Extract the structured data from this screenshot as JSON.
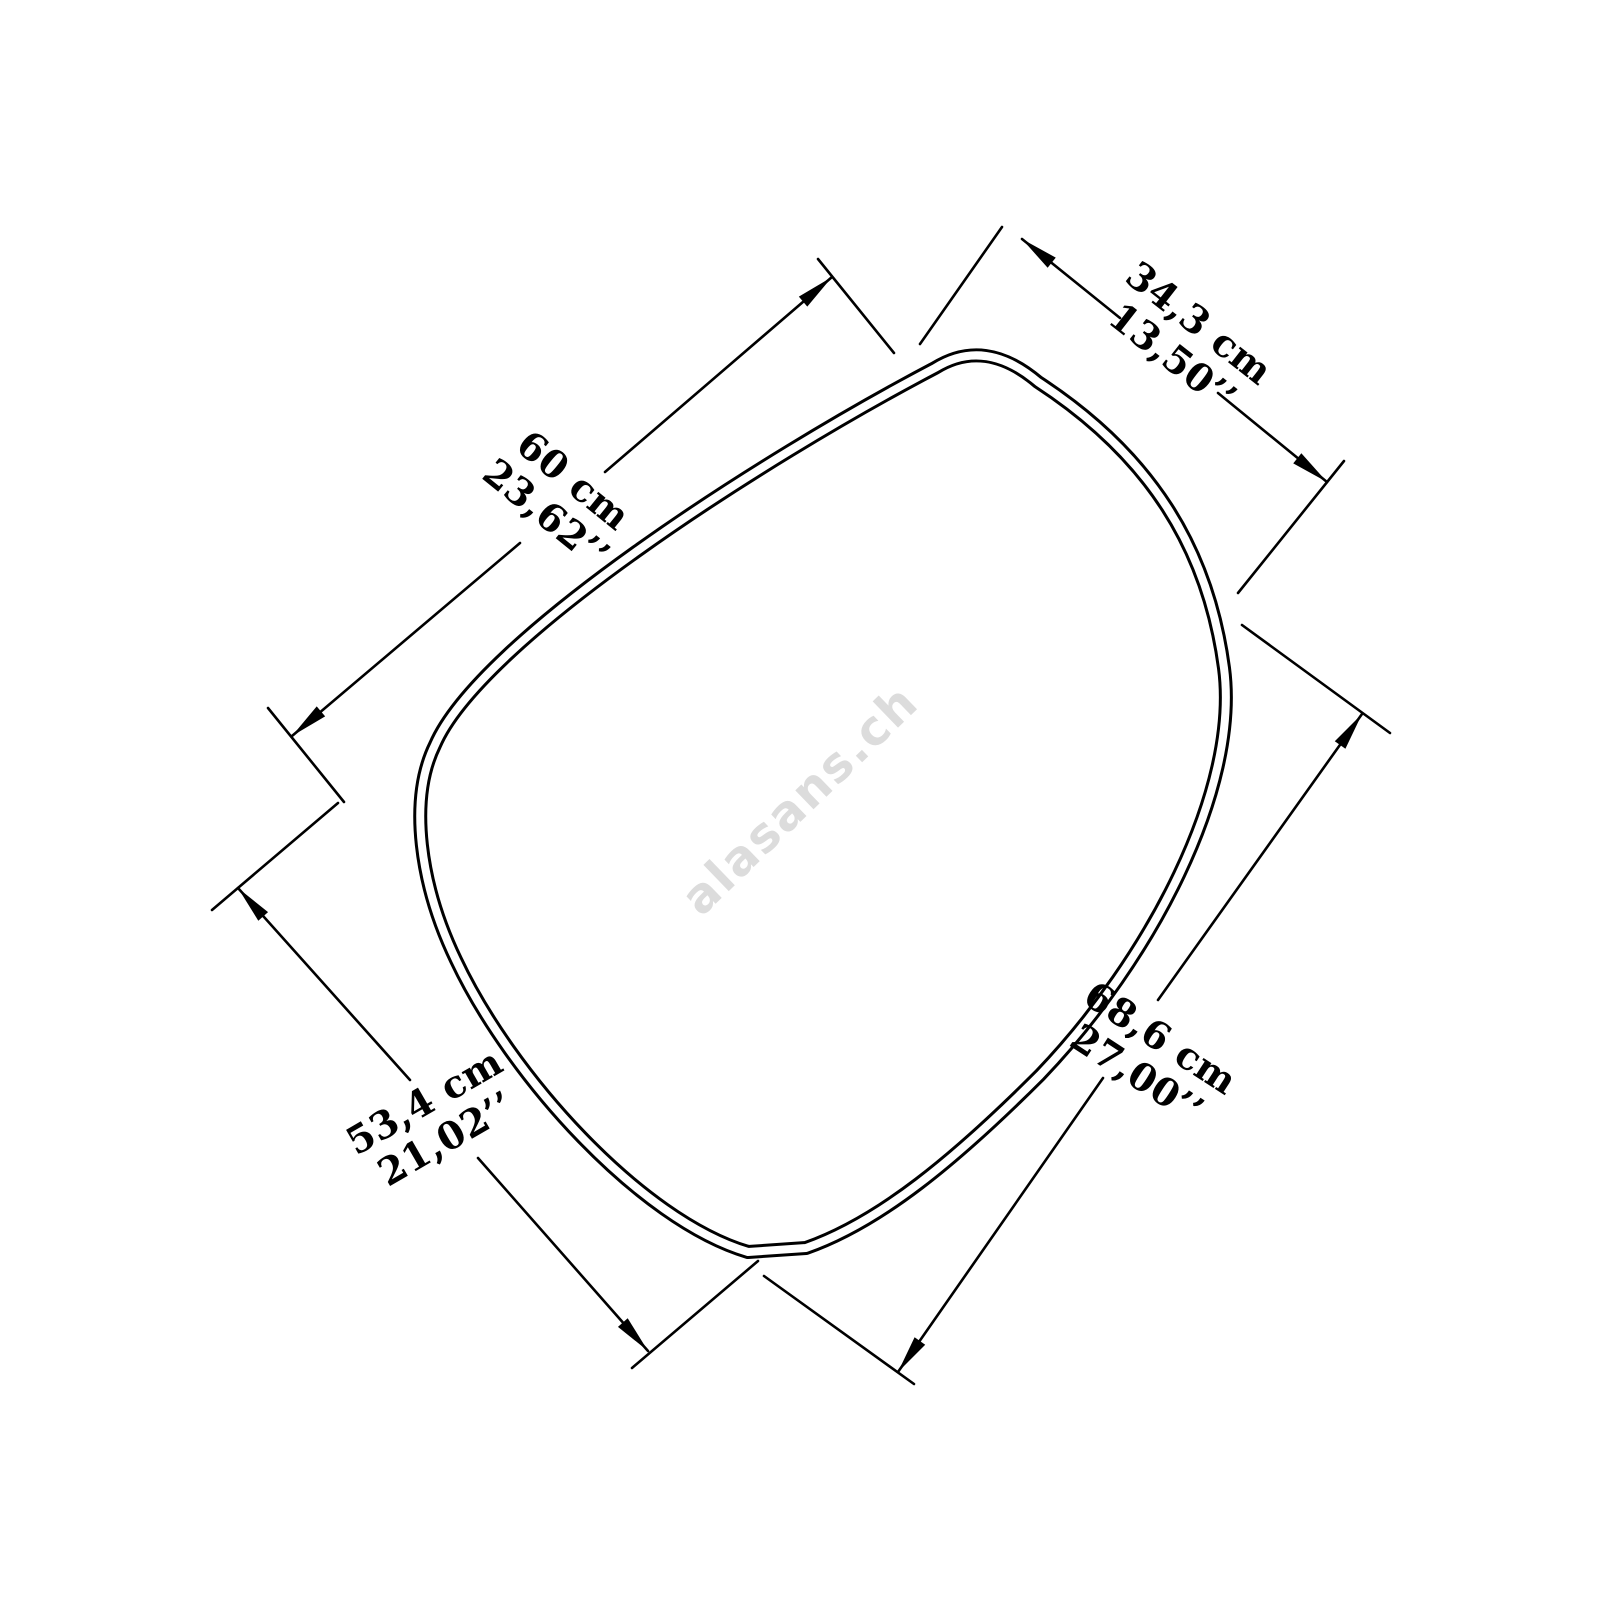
{
  "page": {
    "background": "#ffffff",
    "line_color": "#000000"
  },
  "watermark": {
    "text": "alasans.ch",
    "color": "#dcdcdc"
  },
  "diagram": {
    "shape": "organic-pebble-mirror-outline",
    "dimensions": [
      {
        "edge": "upper-left-edge",
        "cm": "60 cm",
        "inches": "23,62’’"
      },
      {
        "edge": "top-right-edge",
        "cm": "34,3 cm",
        "inches": "13,50’’"
      },
      {
        "edge": "lower-right-edge",
        "cm": "68,6 cm",
        "inches": "27,00’’"
      },
      {
        "edge": "lower-left-edge",
        "cm": "53,4 cm",
        "inches": "21,02’’"
      }
    ]
  }
}
